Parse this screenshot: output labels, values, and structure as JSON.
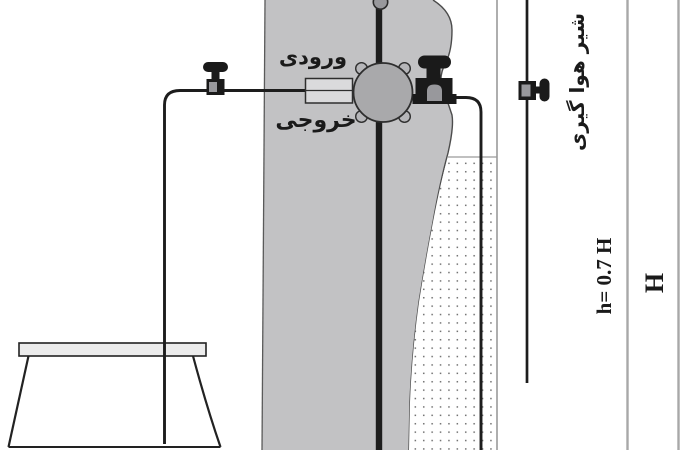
{
  "labels": {
    "inlet": "ورودی",
    "outlet": "خروجی",
    "air_bleed_valve": "شیر هوا گیری",
    "delivery_head": "h= 0.7 H",
    "supply_head": "H"
  },
  "icons": {
    "shutoff_valve": "tap-valve-icon",
    "waste_valve": "tap-valve-icon",
    "air_bleed_valve": "tap-valve-sideways-icon"
  },
  "colors": {
    "band_gray": "#c2c2c4",
    "pump_gray": "#a9a9ab",
    "port_gray": "#dadadc",
    "rim_gray": "#ececec",
    "knob_gray": "#98989c",
    "bolt_gray": "#b6b6b9",
    "line_black": "#1d1d1d",
    "edge_gray": "#4c4c4c",
    "guide_gray": "#a8a8a8",
    "wall_gray": "#9a9a9a",
    "dot_gray": "#707070"
  }
}
